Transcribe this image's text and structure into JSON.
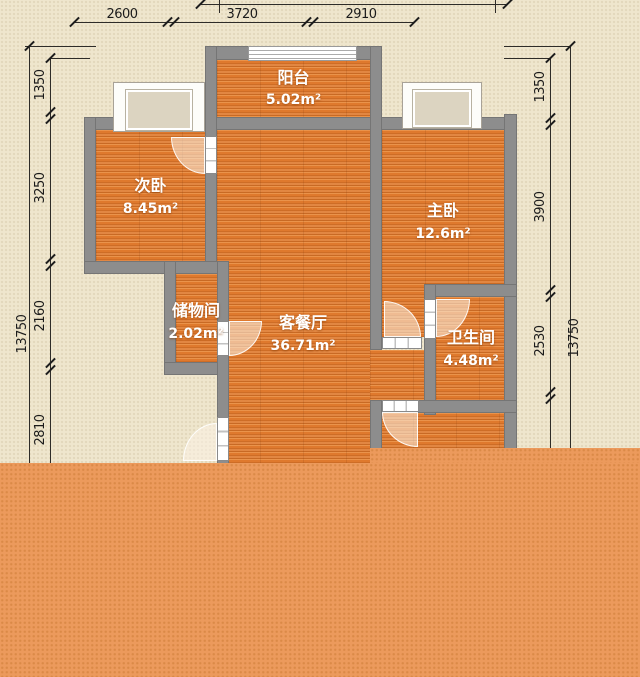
{
  "floorplan": {
    "rooms": [
      {
        "id": "balcony",
        "name": "阳台",
        "area": "5.02m²"
      },
      {
        "id": "second-bedroom",
        "name": "次卧",
        "area": "8.45m²"
      },
      {
        "id": "master-bedroom",
        "name": "主卧",
        "area": "12.6m²"
      },
      {
        "id": "storage",
        "name": "储物间",
        "area": "2.02m²"
      },
      {
        "id": "living-dining",
        "name": "客餐厅",
        "area": "36.71m²"
      },
      {
        "id": "bathroom",
        "name": "卫生间",
        "area": "4.48m²"
      }
    ],
    "dimensions": {
      "top_total": "10130",
      "top_segments": [
        "2600",
        "3720",
        "2910"
      ],
      "left_total": "13750",
      "left_segments": [
        "1350",
        "3250",
        "2160",
        "2810"
      ],
      "right_total": "13750",
      "right_segments": [
        "1350",
        "3900",
        "2530"
      ]
    },
    "colors": {
      "background": "#efe6cd",
      "wall": "#8d8d8d",
      "floor": "#df792d",
      "overlay": "#ec9a5c"
    }
  }
}
